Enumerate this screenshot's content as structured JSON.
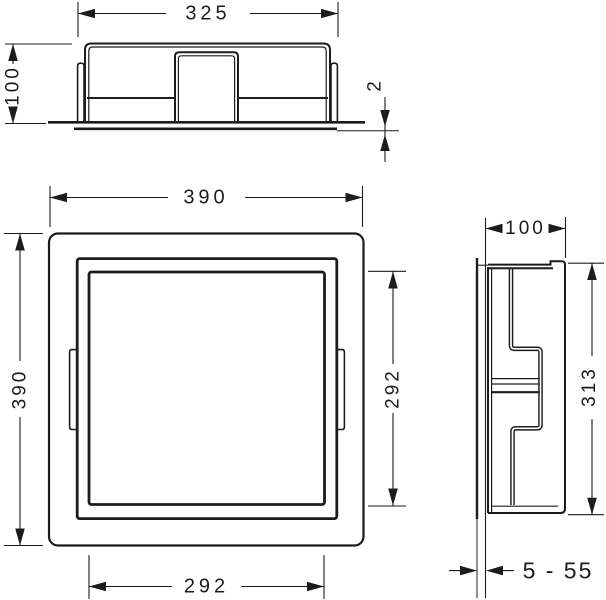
{
  "drawing": {
    "background": "#ffffff",
    "line_color": "#1c1c1c",
    "dims": {
      "top_width": "325",
      "top_height": "100",
      "flange": "2",
      "front_width": "390",
      "front_height": "390",
      "opening_width": "292",
      "opening_height": "292",
      "side_depth": "100",
      "side_height": "313",
      "tile_range": "5 - 55"
    }
  }
}
